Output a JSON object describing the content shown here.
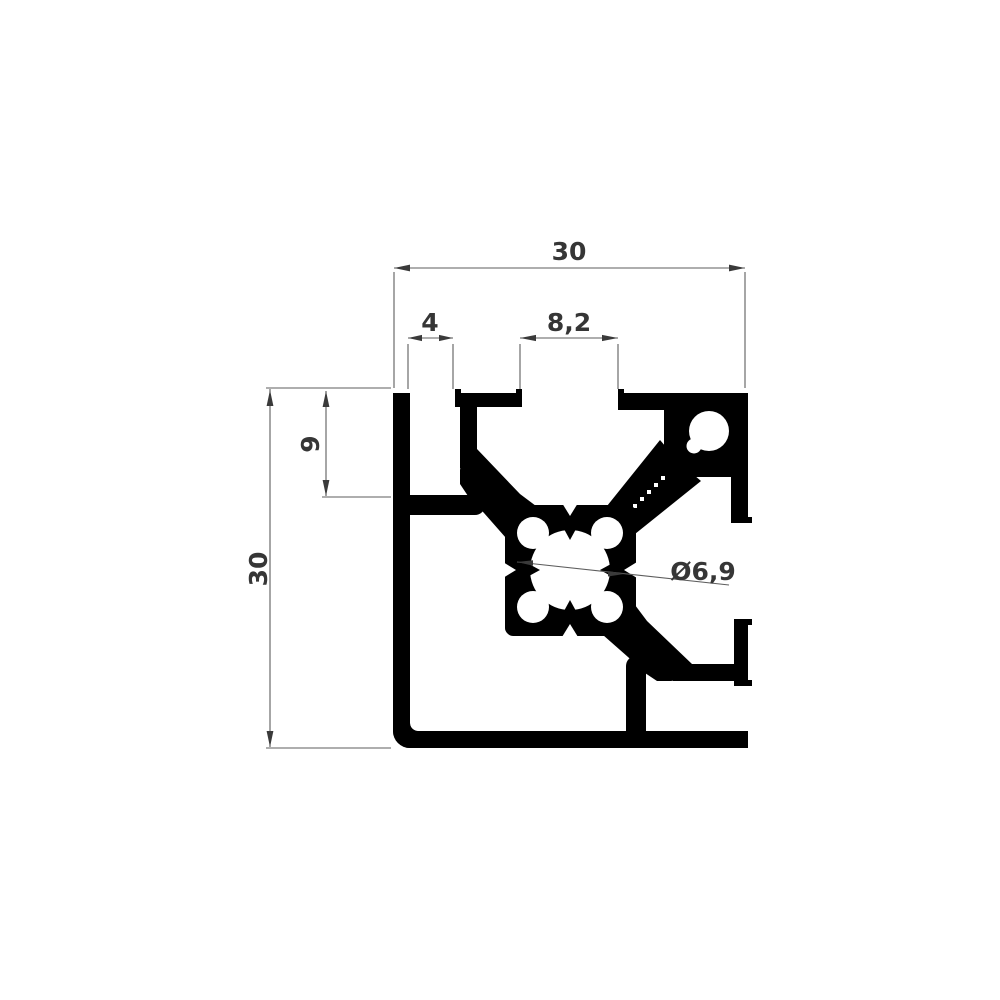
{
  "drawing": {
    "kind": "technical cross-section drawing",
    "part": "30x30 aluminium extrusion profile with T-slots",
    "background_color": "#ffffff",
    "profile_fill_color": "#000000",
    "dimension_line_color": "#5d5d5d",
    "dimension_text_color": "#363636",
    "dimensions": {
      "top_width": "30",
      "left_height": "30",
      "edge_groove_width": "4",
      "t_slot_opening": "8,2",
      "edge_groove_depth": "9",
      "core_hole_diameter": "Ø6,9"
    }
  }
}
